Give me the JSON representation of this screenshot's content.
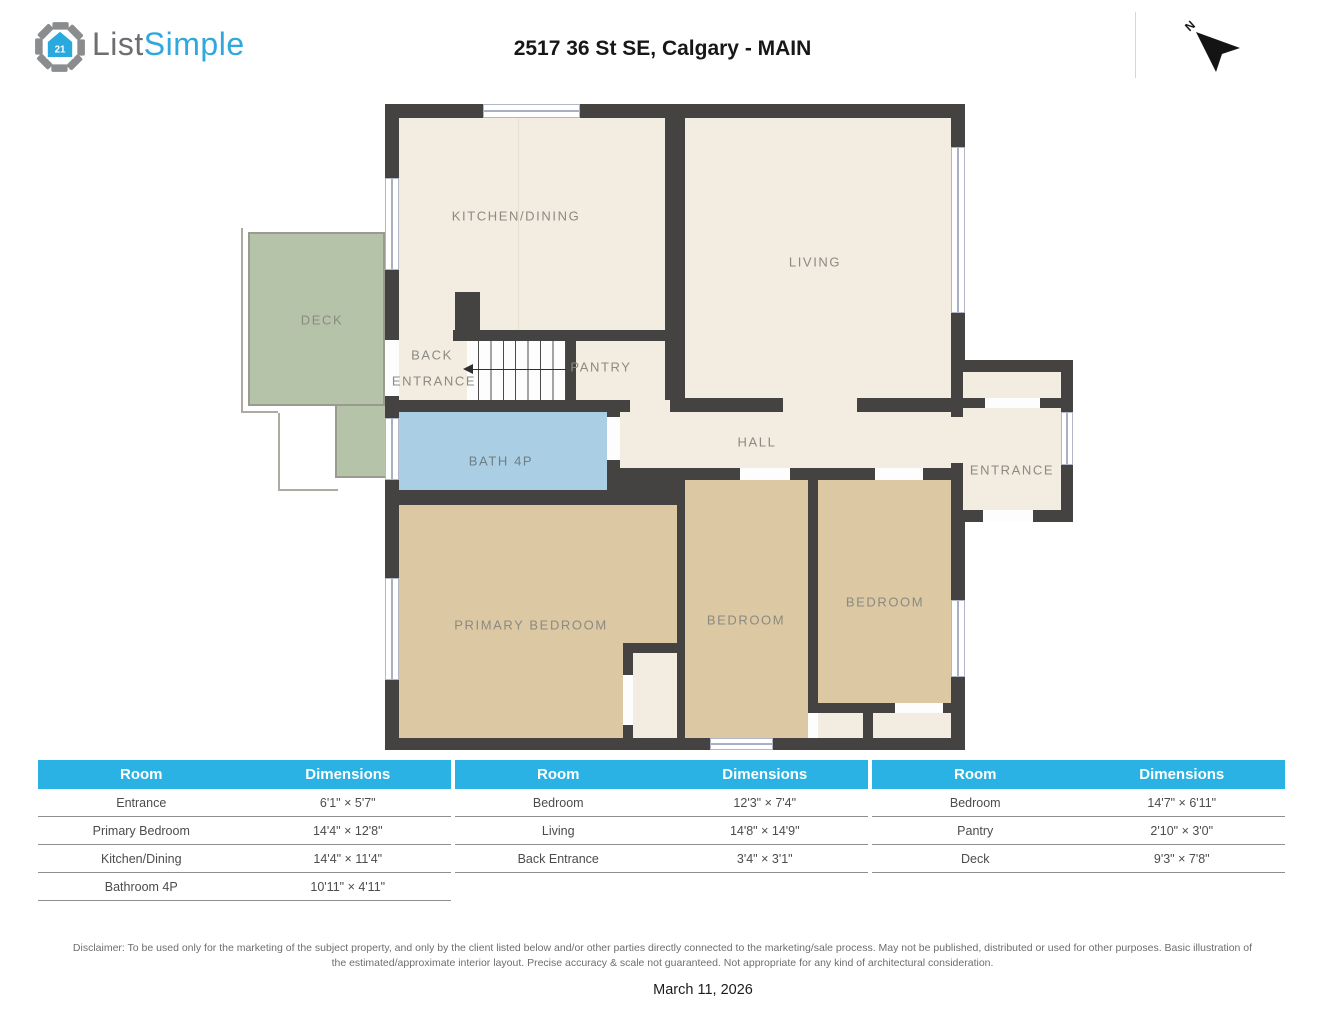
{
  "header": {
    "logo": {
      "part1": "List",
      "part2": "Simple"
    },
    "title": "2517 36 St SE, Calgary - MAIN",
    "compass_label": "N"
  },
  "floorplan": {
    "labels": {
      "kitchen_dining": "KITCHEN/DINING",
      "living": "LIVING",
      "deck": "DECK",
      "back_entrance_line1": "BACK",
      "back_entrance_line2": "ENTRANCE",
      "pantry": "PANTRY",
      "hall": "HALL",
      "entrance": "ENTRANCE",
      "bath": "BATH 4P",
      "primary_bedroom": "PRIMARY BEDROOM",
      "bedroom_middle": "BEDROOM",
      "bedroom_right": "BEDROOM"
    },
    "colors": {
      "wall": "#454341",
      "floor_cream": "#f2ece1",
      "floor_bedroom": "#dcc8a3",
      "floor_bath": "#aacfe5",
      "floor_deck": "#b5c3a9"
    }
  },
  "tables": [
    {
      "headers": [
        "Room",
        "Dimensions"
      ],
      "rows": [
        [
          "Entrance",
          "6'1\" × 5'7\""
        ],
        [
          "Primary Bedroom",
          "14'4\" × 12'8\""
        ],
        [
          "Kitchen/Dining",
          "14'4\" × 11'4\""
        ],
        [
          "Bathroom 4P",
          "10'11\" × 4'11\""
        ]
      ]
    },
    {
      "headers": [
        "Room",
        "Dimensions"
      ],
      "rows": [
        [
          "Bedroom",
          "12'3\" × 7'4\""
        ],
        [
          "Living",
          "14'8\" × 14'9\""
        ],
        [
          "Back Entrance",
          "3'4\" × 3'1\""
        ]
      ]
    },
    {
      "headers": [
        "Room",
        "Dimensions"
      ],
      "rows": [
        [
          "Bedroom",
          "14'7\" × 6'11\""
        ],
        [
          "Pantry",
          "2'10\" × 3'0\""
        ],
        [
          "Deck",
          "9'3\" × 7'8\""
        ]
      ]
    }
  ],
  "footer": {
    "disclaimer_line1": "Disclaimer: To be used only for the marketing of the subject property, and only by the client listed below and/or other parties directly connected to the marketing/sale process. May not be published, distributed or used for other purposes. Basic illustration of",
    "disclaimer_line2": "the estimated/approximate interior layout. Precise accuracy & scale not guaranteed. Not appropriate for any kind of architectural consideration.",
    "date": "March 11, 2026"
  },
  "theme": {
    "accent_blue": "#29b2e3",
    "logo_gray": "#6d6e71",
    "logo_blue": "#2fa8dd"
  }
}
